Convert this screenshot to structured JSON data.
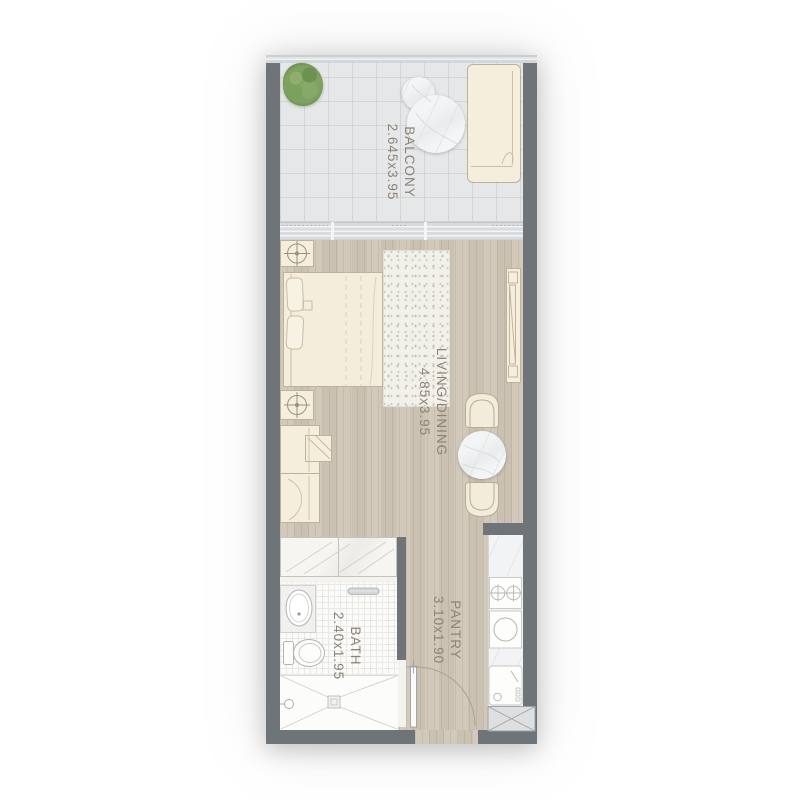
{
  "rooms": {
    "balcony": {
      "name": "BALCONY",
      "dims": "2.645x3.95"
    },
    "living_dining": {
      "name": "LIVING/DINING",
      "dims": "4.85x3.95"
    },
    "bath": {
      "name": "BATH",
      "dims": "2.40x1.95"
    },
    "pantry": {
      "name": "PANTRY",
      "dims": "3.10x1.90"
    }
  },
  "colors": {
    "wall": "#6f7478",
    "wood_floor": "#cfc5b7",
    "balcony_tile": "#e6e7e8",
    "bath_tile": "#fbfbf9",
    "furniture_beige": "#f5eedd",
    "marble": "#eef0f1",
    "label_text": "#8c8375",
    "plant_green": "#7da261",
    "shaft_gray": "#dddfe1"
  },
  "icons": [
    "plant-icon",
    "round-table-icon",
    "lounger-icon",
    "bed-icon",
    "lamp-icon",
    "rug-icon",
    "tv-console-icon",
    "armchair-icon",
    "side-table-icon",
    "dining-table-icon",
    "dining-chair-icon",
    "wardrobe-icon",
    "washbasin-icon",
    "toilet-icon",
    "towel-rail-icon",
    "shower-icon",
    "door-swing-icon",
    "stove-icon",
    "kitchen-sink-icon",
    "washer-icon",
    "ac-shaft-icon"
  ]
}
